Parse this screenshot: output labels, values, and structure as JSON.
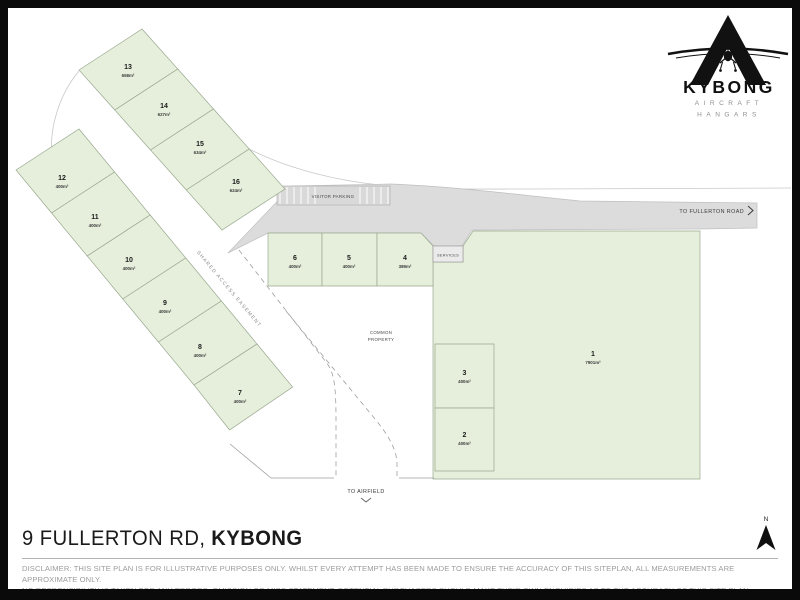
{
  "logo": {
    "name": "KYBONG",
    "subtitle1": "AIRCRAFT",
    "subtitle2": "HANGARS"
  },
  "plan": {
    "lots": [
      {
        "number": "1",
        "area": "7901m²"
      },
      {
        "number": "2",
        "area": "400m²"
      },
      {
        "number": "3",
        "area": "400m²"
      },
      {
        "number": "4",
        "area": "389m²"
      },
      {
        "number": "5",
        "area": "400m²"
      },
      {
        "number": "6",
        "area": "400m²"
      },
      {
        "number": "7",
        "area": "400m²"
      },
      {
        "number": "8",
        "area": "400m²"
      },
      {
        "number": "9",
        "area": "400m²"
      },
      {
        "number": "10",
        "area": "400m²"
      },
      {
        "number": "11",
        "area": "400m²"
      },
      {
        "number": "12",
        "area": "400m²"
      },
      {
        "number": "13",
        "area": "658m²"
      },
      {
        "number": "14",
        "area": "627m²"
      },
      {
        "number": "15",
        "area": "634m²"
      },
      {
        "number": "16",
        "area": "624m²"
      }
    ],
    "labels": {
      "visitor_parking": "VISITOR PARKING",
      "to_fullerton_road": "TO FULLERTON ROAD",
      "services": "SERVICES",
      "shared_access_easement": "SHARED ACCESS EASEMENT",
      "common_property_line1": "COMMON",
      "common_property_line2": "PROPERTY",
      "to_airfield": "TO AIRFIELD",
      "north": "N"
    }
  },
  "footer": {
    "address_prefix": "9 FULLERTON RD,",
    "address_bold": "KYBONG",
    "disclaimer_line1": "DISCLAIMER: THIS SITE PLAN IS FOR ILLUSTRATIVE PURPOSES ONLY. WHILST EVERY ATTEMPT HAS BEEN MADE TO ENSURE THE ACCURACY OF THIS SITEPLAN, ALL MEASUREMENTS ARE APPROXIMATE ONLY.",
    "disclaimer_line2": "NO RESPONSIBILITY IS TAKEN FOR ANY ERRORS, OMISSION OR MISS-STATEMENT. POTENTIAL PURCHASERS SHOULD MAKE THEIR OWN ENQUIRIES AS TO THE ACCURACY OF THIS SITE PLAN."
  },
  "colors": {
    "lot_fill": "#e5efdb",
    "lot_stroke": "#9aa890",
    "road_fill": "#dcdcdc",
    "frame": "#0a0a0a"
  }
}
